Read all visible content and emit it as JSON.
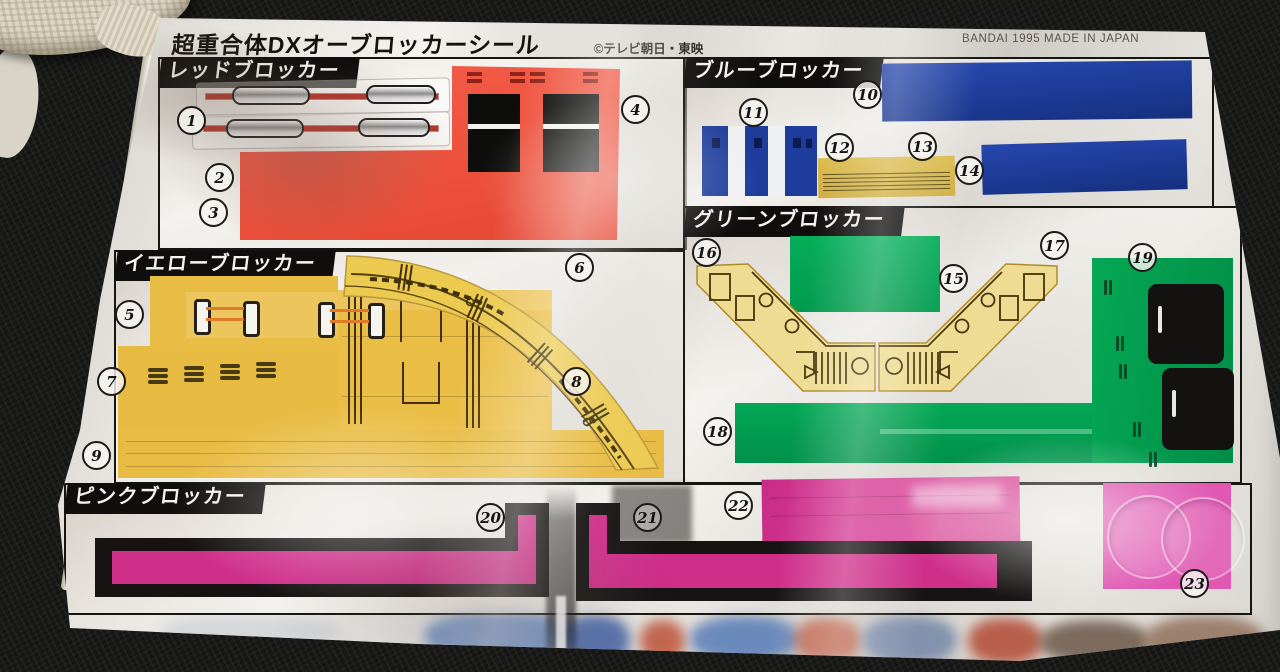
{
  "sheet": {
    "title": "超重合体DXオーブロッカーシール",
    "copyright": "©テレビ朝日・東映",
    "manufacturer_mark": "BANDAI 1995 MADE IN JAPAN"
  },
  "sections": {
    "red": {
      "label": "レッドブロッカー",
      "sticker_numbers": [
        "1",
        "2",
        "3",
        "4"
      ]
    },
    "blue": {
      "label": "ブルーブロッカー",
      "sticker_numbers": [
        "10",
        "11",
        "12",
        "13",
        "14"
      ]
    },
    "yellow": {
      "label": "イエローブロッカー",
      "sticker_numbers": [
        "5",
        "6",
        "7",
        "8",
        "9"
      ]
    },
    "green": {
      "label": "グリーンブロッカー",
      "sticker_numbers": [
        "15",
        "16",
        "17",
        "18",
        "19"
      ]
    },
    "pink": {
      "label": "ピンクブロッカー",
      "sticker_numbers": [
        "20",
        "21",
        "22",
        "23"
      ]
    }
  },
  "badges": {
    "b1": "1",
    "b2": "2",
    "b3": "3",
    "b4": "4",
    "b5": "5",
    "b6": "6",
    "b7": "7",
    "b8": "8",
    "b9": "9",
    "b10": "10",
    "b11": "11",
    "b12": "12",
    "b13": "13",
    "b14": "14",
    "b15": "15",
    "b16": "16",
    "b17": "17",
    "b18": "18",
    "b19": "19",
    "b20": "20",
    "b21": "21",
    "b22": "22",
    "b23": "23"
  },
  "colors": {
    "red_sticker": "#f05847",
    "blue_sticker": "#1c3f9e",
    "yellow_sticker": "#e9bc43",
    "green_sticker": "#00a551",
    "pink_sticker": "#d2308b",
    "pale_yellow_sticker": "#eedc92",
    "label_background": "#0f0e0c",
    "sheet_foil": "#dedbd5",
    "background_fabric": "#1a1a1a"
  }
}
